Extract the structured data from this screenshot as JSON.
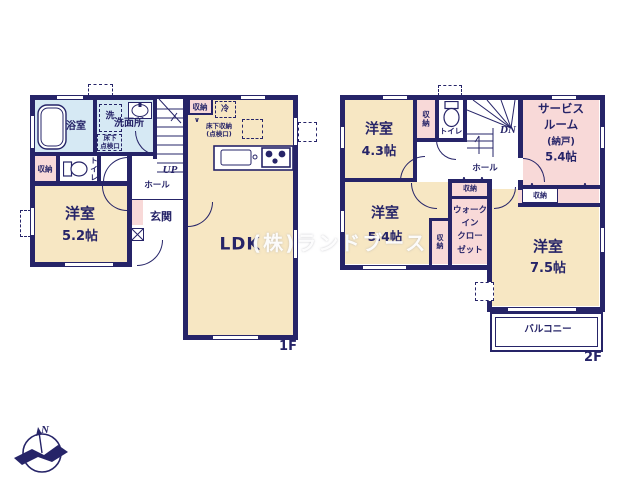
{
  "watermark": "(株)ランドブース",
  "compass": {
    "north": "N"
  },
  "colors": {
    "wall": "#262468",
    "room": "#f7e7c3",
    "closet": "#f8d9d8",
    "bath": "#d6e9f4"
  },
  "f1": {
    "floor": "1F",
    "bath": "浴室",
    "wash_machine": "洗",
    "washroom": "洗面所",
    "hatch_line1": "床下",
    "hatch_line2": "点検口",
    "closet_left": "収納",
    "toilet": "トイレ",
    "bedroom_name": "洋室",
    "bedroom_size": "5.2帖",
    "hall": "ホール",
    "up": "UP",
    "entrance": "玄関",
    "closet_top": "収納",
    "fridge": "冷",
    "floor_storage_line1": "床下収納",
    "floor_storage_line2": "(点検口)",
    "ldk": "LDK"
  },
  "f2": {
    "floor": "2F",
    "b43_name": "洋室",
    "b43_size": "4.3帖",
    "closet_a": "収納",
    "toilet": "トイレ",
    "dn": "DN",
    "hall": "ホール",
    "sr_line1": "サービス",
    "sr_line2": "ルーム",
    "sr_line3": "(納戸)",
    "sr_size": "5.4帖",
    "closet_b": "収納",
    "b54_name": "洋室",
    "b54_size": "5.4帖",
    "closet_c": "収納",
    "wic_closet": "収納",
    "wic_line1": "ウォーク",
    "wic_line2": "イン",
    "wic_line3": "クロー",
    "wic_line4": "ゼット",
    "b75_name": "洋室",
    "b75_size": "7.5帖",
    "balcony": "バルコニー"
  }
}
